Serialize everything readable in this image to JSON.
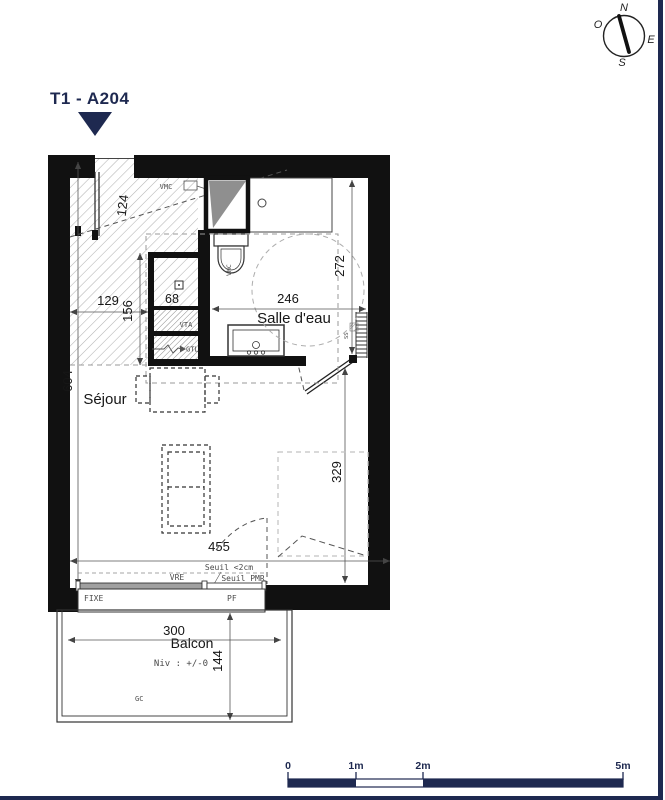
{
  "title": "T1 - A204",
  "compass": {
    "n": "N",
    "e": "E",
    "s": "S",
    "w": "O"
  },
  "rooms": {
    "bathroom": "Salle d'eau",
    "living": "Séjour",
    "balcony": "Balcon"
  },
  "dimensions": {
    "d124": "124",
    "d129": "129",
    "d156": "156",
    "d68": "68",
    "d604": "604",
    "d246": "246",
    "d272": "272",
    "d329": "329",
    "d455": "455",
    "d300": "300",
    "d144": "144"
  },
  "annotations": {
    "vmc": "VMC",
    "wc_vmc": "VMC",
    "vta": "VTA",
    "gtl": "GTL",
    "ss": "SS",
    "seuil": "Seuil <2cm",
    "seuil_pmr": "Seuil PMR",
    "vre": "VRE",
    "fixe": "FIXE",
    "pf": "PF",
    "niv": "Niv : +/-0",
    "gc": "GC"
  },
  "scalebar": {
    "t0": "0",
    "t1": "1m",
    "t2": "2m",
    "t5": "5m"
  },
  "colors": {
    "navy": "#1e2950",
    "wall": "#111111",
    "hatch": "#b3b3b3",
    "dash_gray": "#9a9a9a"
  }
}
